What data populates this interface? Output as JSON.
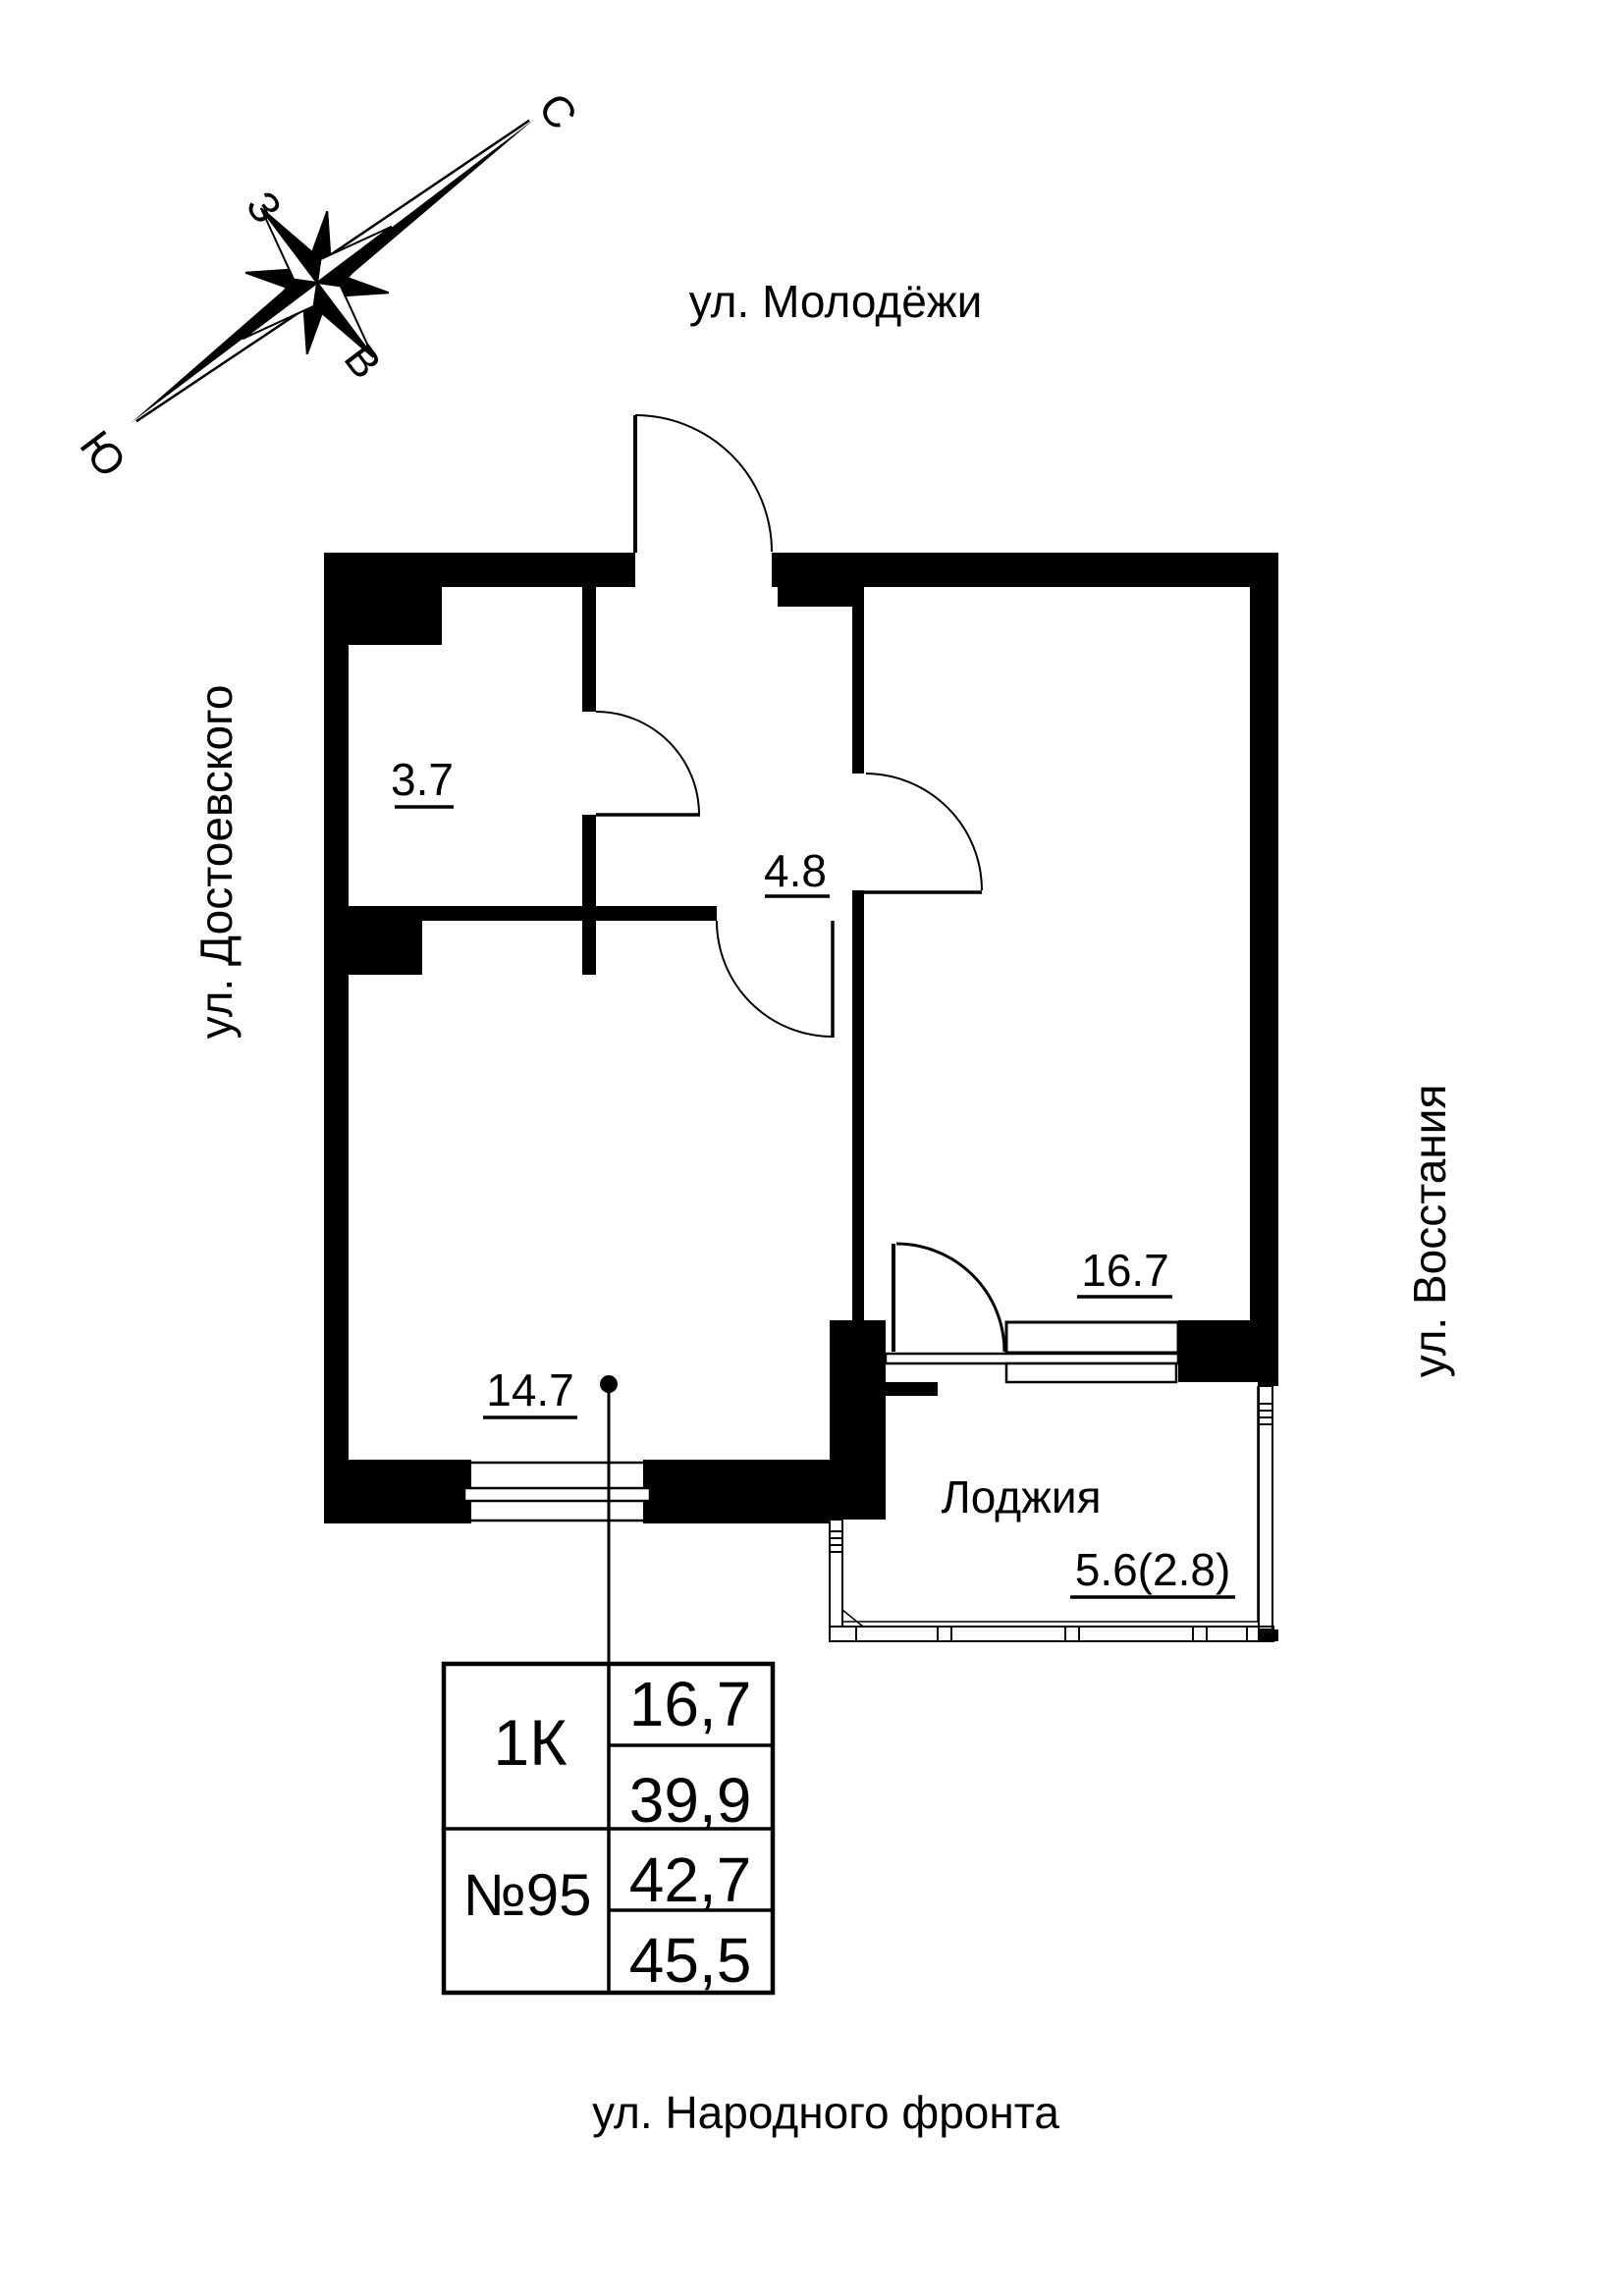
{
  "compass": {
    "n": "С",
    "e": "В",
    "s": "Ю",
    "w": "З"
  },
  "streets": {
    "top": "ул. Молодёжи",
    "left": "ул. Достоевского",
    "right": "ул. Восстания",
    "bottom": "ул. Народного фронта"
  },
  "rooms": {
    "bathroom_area": "3.7",
    "hall_area": "4.8",
    "room_area": "14.7",
    "living_area": "16.7",
    "loggia_name": "Лоджия",
    "loggia_area": "5.6(2.8)"
  },
  "info_table": {
    "flat_type": "1К",
    "flat_number": "№95",
    "values": [
      "16,7",
      "39,9",
      "42,7",
      "45,5"
    ]
  },
  "colors": {
    "ink": "#000000",
    "paper": "#ffffff"
  }
}
